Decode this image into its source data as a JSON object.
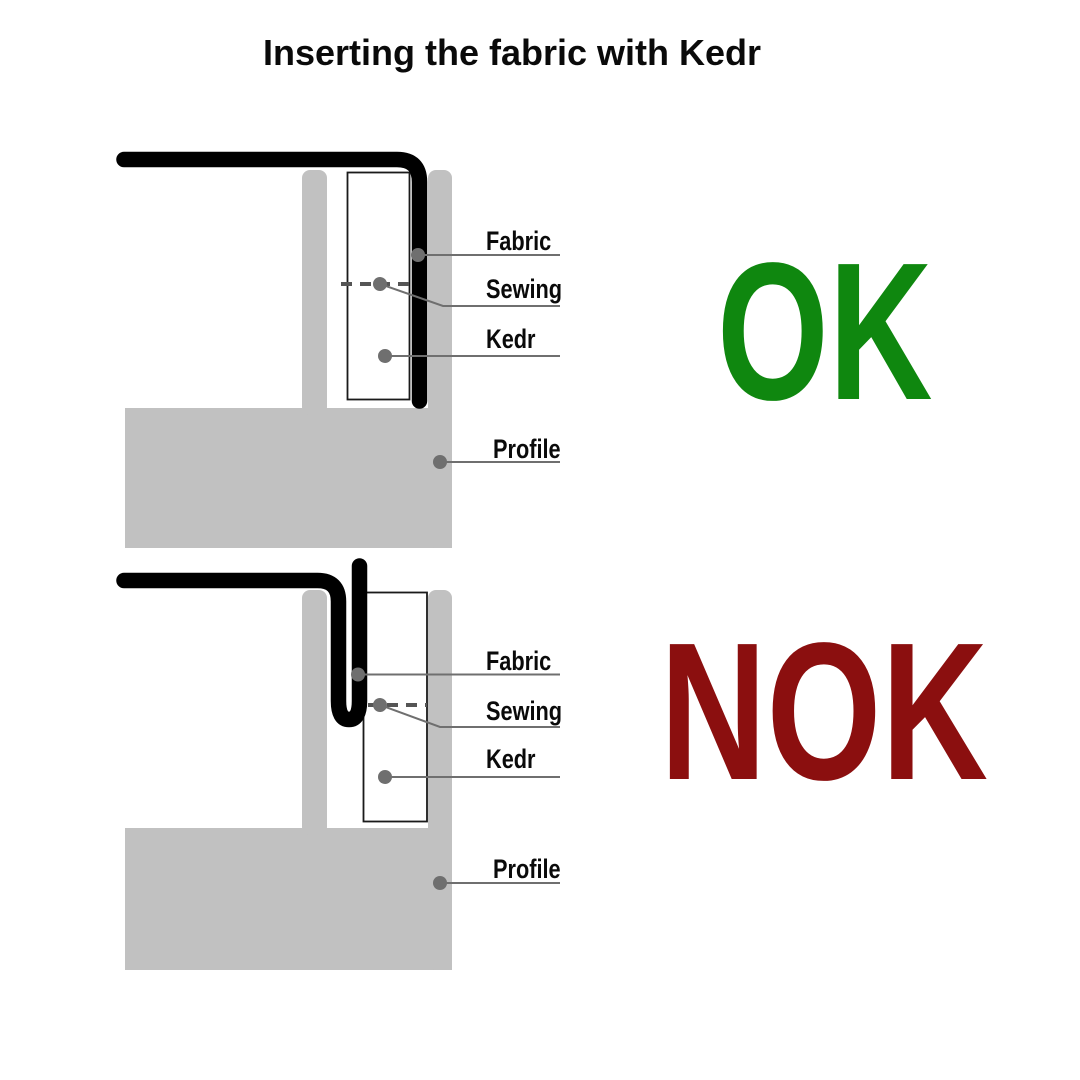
{
  "title": "Inserting the fabric with Kedr",
  "colors": {
    "ok_green": "#0f870f",
    "nok_red": "#8b0f0f",
    "profile_gray": "#c1c1c1",
    "leader_gray": "#6f6f6f",
    "stitch_gray": "#555555",
    "fabric_black": "#000000"
  },
  "diagrams": [
    {
      "verdict": "OK",
      "labels": {
        "fabric": "Fabric",
        "sewing": "Sewing",
        "kedr": "Kedr",
        "profile": "Profile"
      }
    },
    {
      "verdict": "NOK",
      "labels": {
        "fabric": "Fabric",
        "sewing": "Sewing",
        "kedr": "Kedr",
        "profile": "Profile"
      }
    }
  ]
}
